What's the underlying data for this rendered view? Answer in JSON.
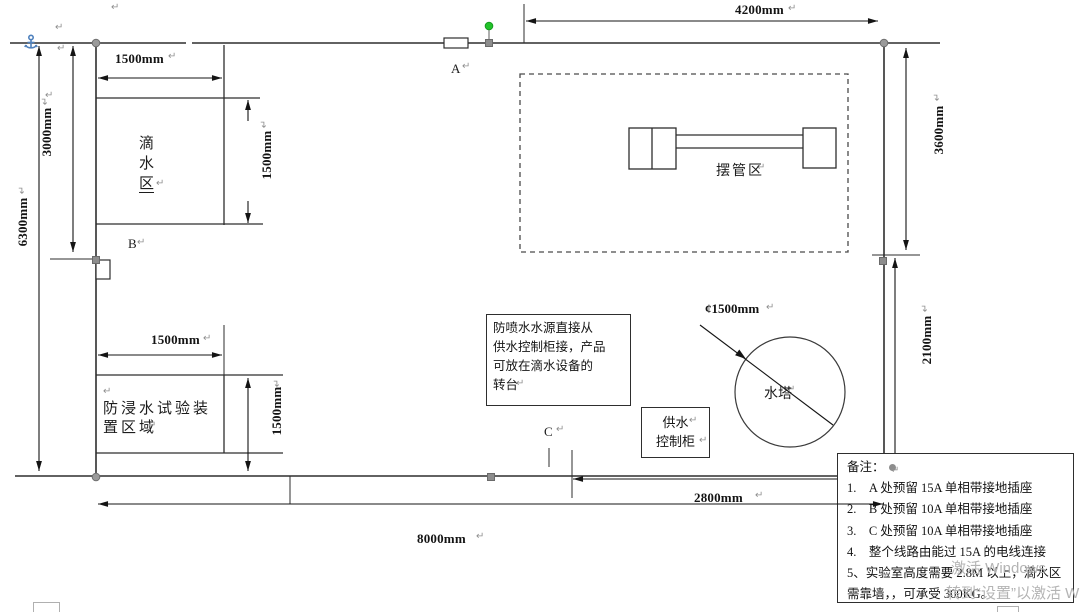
{
  "colors": {
    "line": "#2e2e2e",
    "dim_line": "#141414",
    "handle_gray": "#8d8d8d",
    "handle_green": "#22c32a",
    "anchor_blue": "#4f81bd",
    "watermark_gray": "#b4b4b4"
  },
  "marks": {
    "pilcrow": "↵"
  },
  "plan": {
    "points": {
      "a": "A",
      "b": "B",
      "c": "C"
    },
    "areas": {
      "drip": {
        "chars": [
          "滴",
          "水",
          "区"
        ]
      },
      "swing": "摆管区",
      "tower": "水塔",
      "immersion": {
        "line1": "防浸水试验装",
        "line2": "置区域"
      },
      "cabinet": {
        "line1": "供水",
        "line2": "控制柜"
      }
    },
    "dims": {
      "top": "4200mm",
      "left_total": "6300mm",
      "left_upper": "3000mm",
      "drip_w": "1500mm",
      "drip_h": "1500mm",
      "right_upper": "3600mm",
      "right_lower": "2100mm",
      "imm_w": "1500mm",
      "imm_h": "1500mm",
      "bottom_right": "2800mm",
      "bottom_total": "8000mm",
      "tower_dia": "¢1500mm"
    },
    "callout": {
      "line1": "防喷水水源直接从",
      "line2": "供水控制柜接，产品",
      "line3": "可放在滴水设备的",
      "line4": "转台"
    },
    "remarks": {
      "title": "备注：",
      "items": [
        "1.　A 处预留 15A 单相带接地插座",
        "2.　B 处预留 10A 单相带接地插座",
        "3.　C 处预留 10A 单相带接地插座",
        "4.　整个线路由能过 15A 的电线连接",
        "5、实验室高度需要 2.8M 以上，滴水区",
        "需靠墙，，可承受 300KG。"
      ]
    },
    "watermark": {
      "line1": "激活 Windows",
      "line2": "转到“设置”以激活 Windows。"
    }
  }
}
